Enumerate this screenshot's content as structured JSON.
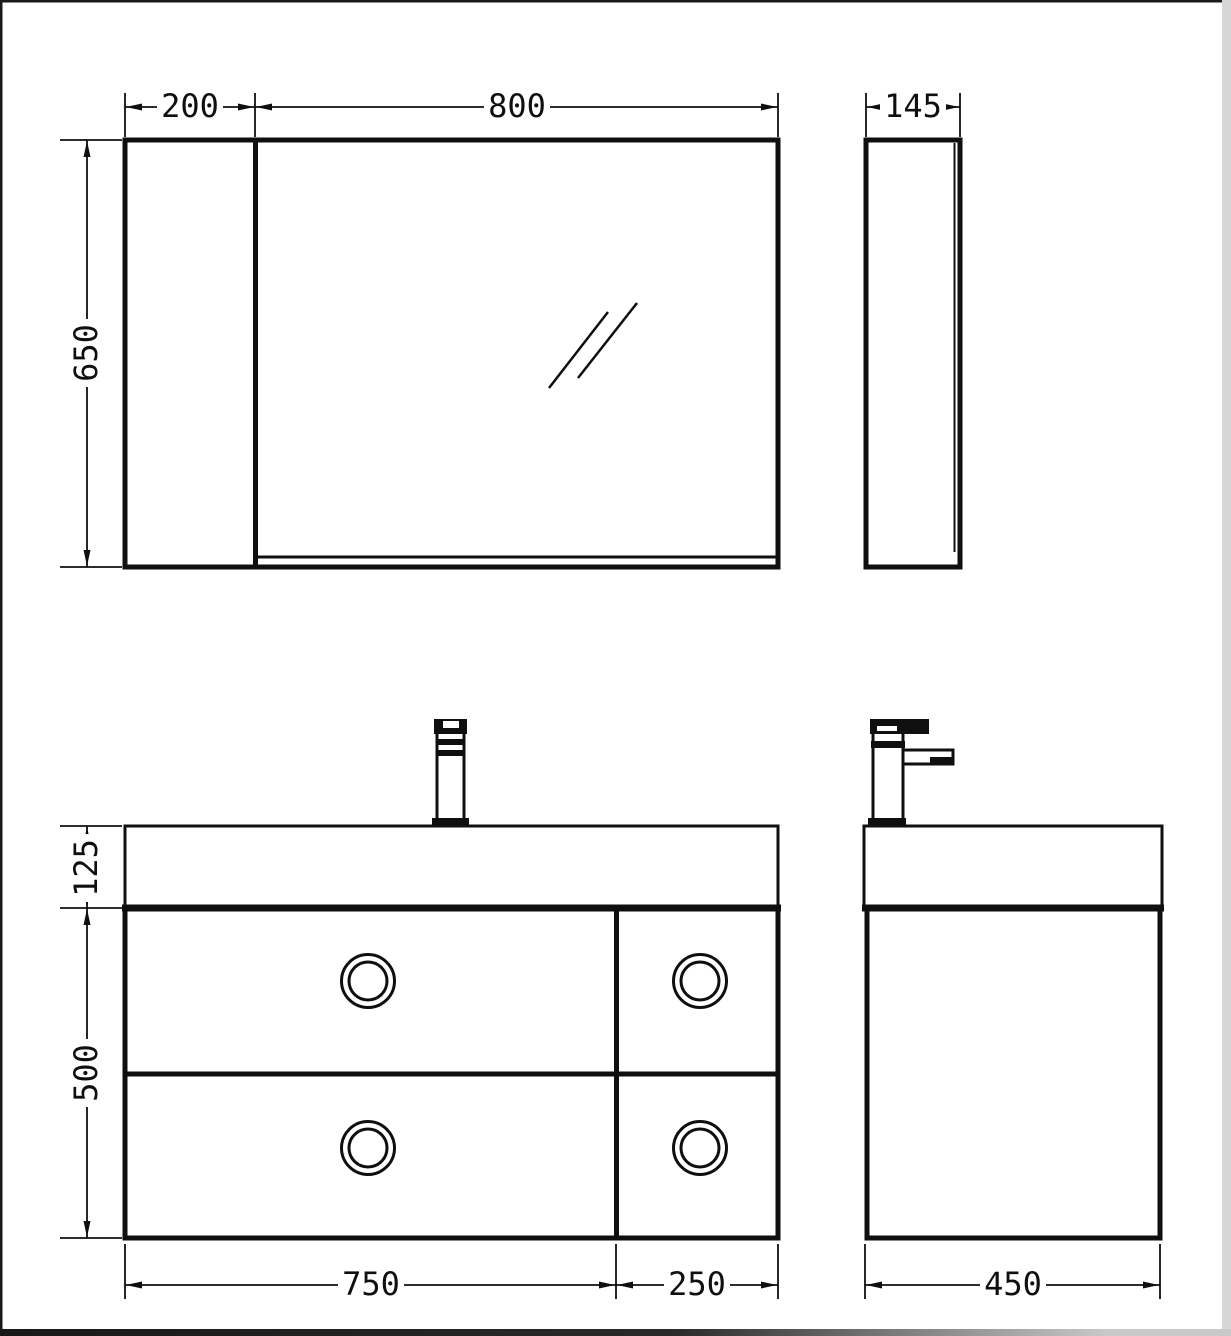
{
  "dimensions": {
    "mirror_side_width": "200",
    "mirror_door_width": "800",
    "mirror_height": "650",
    "mirror_depth": "145",
    "basin_height": "125",
    "cabinet_height": "500",
    "drawers_left_width": "750",
    "drawers_right_width": "250",
    "vanity_depth": "450"
  },
  "colors": {
    "line": "#0f0f0f",
    "background": "#ffffff",
    "frame_dark": "#1a1a1a",
    "frame_light": "#d6d6d6"
  }
}
